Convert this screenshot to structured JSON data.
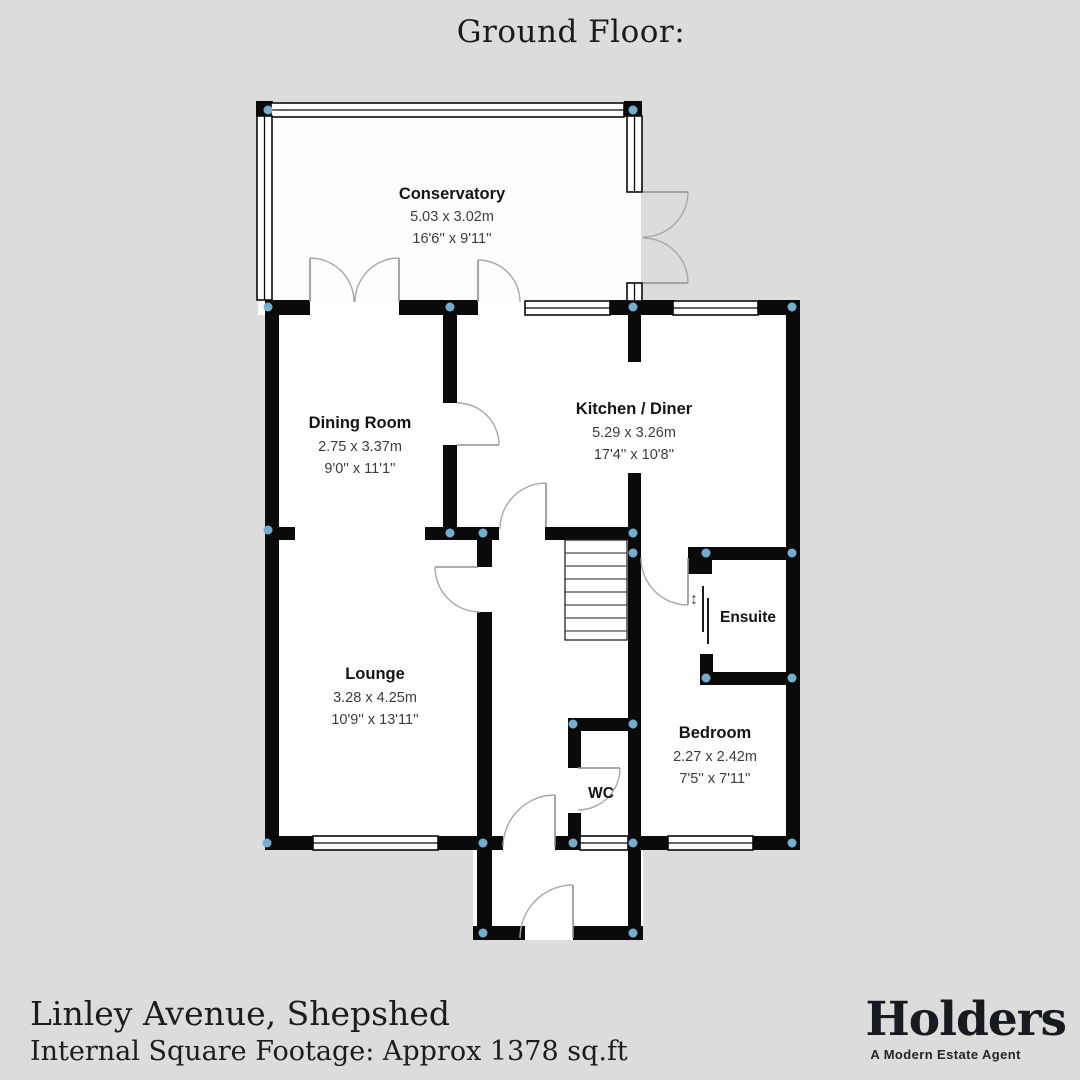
{
  "page": {
    "title": "Ground Floor:"
  },
  "rooms": {
    "conservatory": {
      "name": "Conservatory",
      "metric": "5.03 x 3.02m",
      "imperial": "16'6'' x 9'11''"
    },
    "dining_room": {
      "name": "Dining Room",
      "metric": "2.75 x 3.37m",
      "imperial": "9'0'' x 11'1''"
    },
    "kitchen_diner": {
      "name": "Kitchen / Diner",
      "metric": "5.29 x 3.26m",
      "imperial": "17'4'' x 10'8''"
    },
    "lounge": {
      "name": "Lounge",
      "metric": "3.28 x 4.25m",
      "imperial": "10'9'' x 13'11''"
    },
    "ensuite": {
      "name": "Ensuite"
    },
    "bedroom": {
      "name": "Bedroom",
      "metric": "2.27 x 2.42m",
      "imperial": "7'5'' x 7'11''"
    },
    "wc": {
      "name": "WC"
    },
    "slide_arrow": {
      "glyph": "↕"
    }
  },
  "footer": {
    "address": "Linley Avenue, Shepshed",
    "footage": "Internal Square Footage: Approx 1378 sq.ft"
  },
  "brand": {
    "name": "Holders",
    "tagline": "A Modern Estate Agent"
  },
  "colors": {
    "background": "#dcdcdd",
    "wall": "#0a0a0a",
    "room_fill": "#ffffff",
    "junction_dot": "#74aecf",
    "door_arc": "#a8a8a8",
    "brand_text": "#171a20"
  }
}
